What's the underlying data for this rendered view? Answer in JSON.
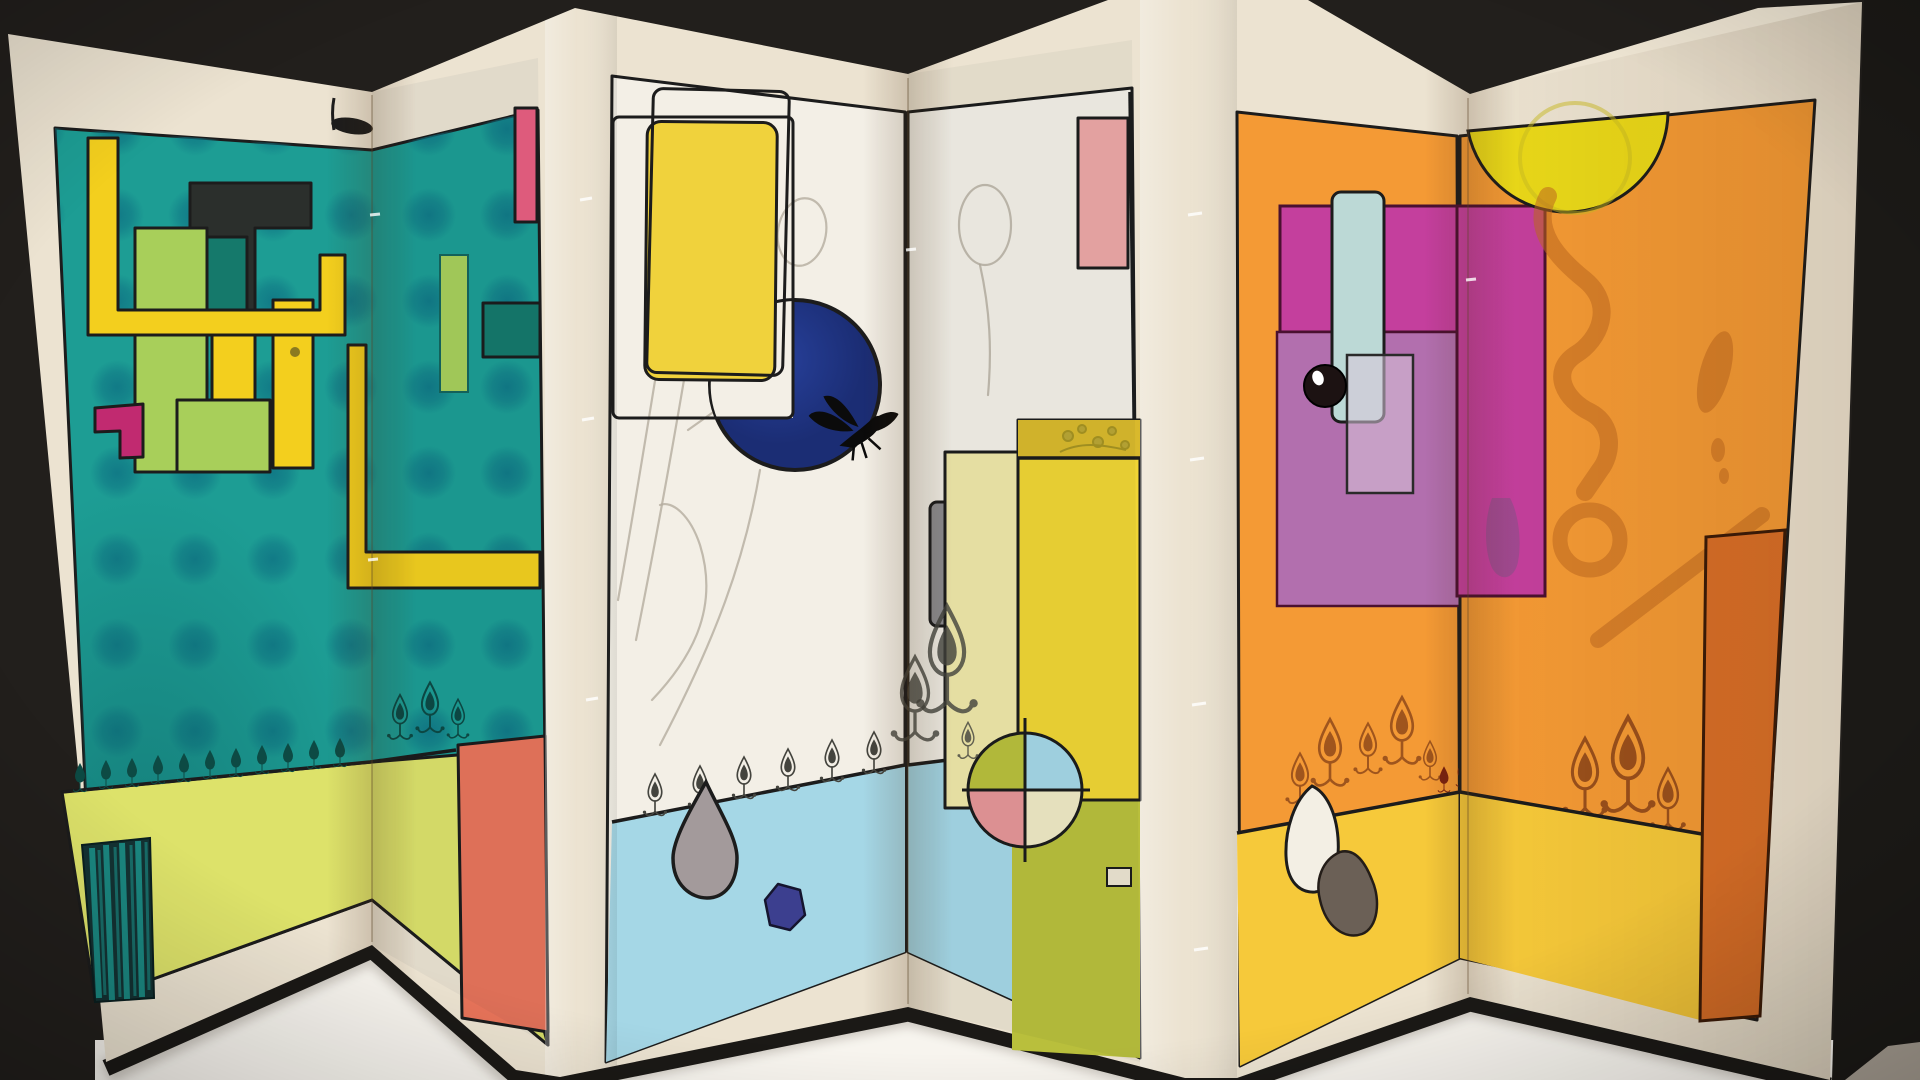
{
  "scene": {
    "type": "photograph",
    "subject": "six-panel accordion folding screen (concertina artist book) with abstract watercolor-and-ink composition",
    "setting": "displayed standing in zigzag on a white table against a black gallery wall",
    "text_visible": "none"
  },
  "palette": {
    "bg-dark": "#221f1c",
    "bg-black": "#1b1916",
    "floor-white": "#f7f4ee",
    "floor-gray": "#a89f93",
    "paper": "#ece3d1",
    "ink": "#1c1c1c",
    "teal": "#1d9d94",
    "teal-dot": "#0f7484",
    "teal-deep": "#0c5e60",
    "candle-dark": "#0d4a44",
    "floor-green": "#dde26a",
    "pipe-yellow": "#f3cf1e",
    "light-green": "#a8cf5a",
    "dark-teal": "#15796b",
    "black-rect": "#2b2f2c",
    "magenta-elbow": "#c12a70",
    "pink-stripe": "#e85f80",
    "red-orange": "#e8745a",
    "panel-white": "#f3efe6",
    "panel-yellow": "#f0d23c",
    "navy": "#27409a",
    "navy-deep": "#1b2d74",
    "sketch": "#b4ad9f",
    "light-blue": "#a5d7e6",
    "gray-drop": "#a39a9b",
    "navy-blob": "#3c3f8f",
    "pink-rect": "#eda7a6",
    "gray-bar": "#8e8d90",
    "pale-yellow": "#efe6a8",
    "bright-yellow": "#f0d535",
    "mustard": "#d9b92c",
    "olive": "#b9bf3c",
    "quad-pink": "#e59597",
    "quad-cream": "#efe9c4",
    "orange": "#f49a35",
    "orange-deep": "#d96f28",
    "magenta": "#c43f9d",
    "mauve": "#b26fae",
    "lavender": "#d9c6da",
    "sky-bar": "#bcd9d6",
    "sun": "#ead919",
    "sienna": "#c06a20",
    "sienna-ink": "#8a4418",
    "floor-yellow": "#f6c93a",
    "egg": "#f3efe4",
    "stone": "#6b6056",
    "red-candle": "#7a2210",
    "ink-soft": "#44443e"
  },
  "artwork": {
    "panels": [
      {
        "id": 1,
        "base": "teal with grid of soft darker dots",
        "motifs": [
          "yellow U-shaped pipe line",
          "black rectangle with dark-teal inset",
          "light green columns",
          "yellow columns",
          "magenta elbow",
          "black sprout on top edge",
          "row of small dark candle/flame motifs",
          "yellow-green floor band",
          "black streaked column at lower left"
        ]
      },
      {
        "id": 2,
        "base": "teal with dots (continuation)",
        "motifs": [
          "crimson stripe at top right",
          "light green bar",
          "dark teal rectangle",
          "yellow L-shaped frame",
          "red-orange rectangle on floor",
          "sketched candles near fold"
        ]
      },
      {
        "id": 3,
        "base": "white paper",
        "motifs": [
          "two outlined ink rectangles",
          "yellow rounded rectangle",
          "large navy circle with white notch",
          "black insect silhouette",
          "pencil plant sketches",
          "row of ink candle motifs",
          "light blue floor",
          "gray teardrop",
          "navy pebble"
        ]
      },
      {
        "id": 4,
        "base": "white paper",
        "motifs": [
          "pink rectangle top right",
          "ink room-corner lines",
          "gray bar",
          "pale yellow rectangle",
          "bright yellow rectangle with mustard band and floral sketch",
          "four-color quadrant circle",
          "light blue and olive floor",
          "tiny white rectangle",
          "large sketched candles near fold"
        ]
      },
      {
        "id": 5,
        "base": "orange",
        "motifs": [
          "vivid magenta band",
          "lighter mauve block",
          "pale blue vertical bar",
          "black ball with highlight",
          "translucent lavender rectangle",
          "sienna candle doodles",
          "yellow floor",
          "white egg blob",
          "dark stone blob"
        ]
      },
      {
        "id": 6,
        "base": "orange",
        "motifs": [
          "yellow half-disc sun",
          "sienna watercolor calligraphy marks",
          "leaf mark",
          "diagonal sienna stroke",
          "dark orange vertical strip",
          "candle doodles",
          "yellow floor"
        ]
      }
    ],
    "structure": "panels joined accordion-style; valley folds between 1-2, 3-4, 5-6; bright ridge spines between 2-3 and 4-5 with visible stitching; black bottom rim on every panel"
  }
}
